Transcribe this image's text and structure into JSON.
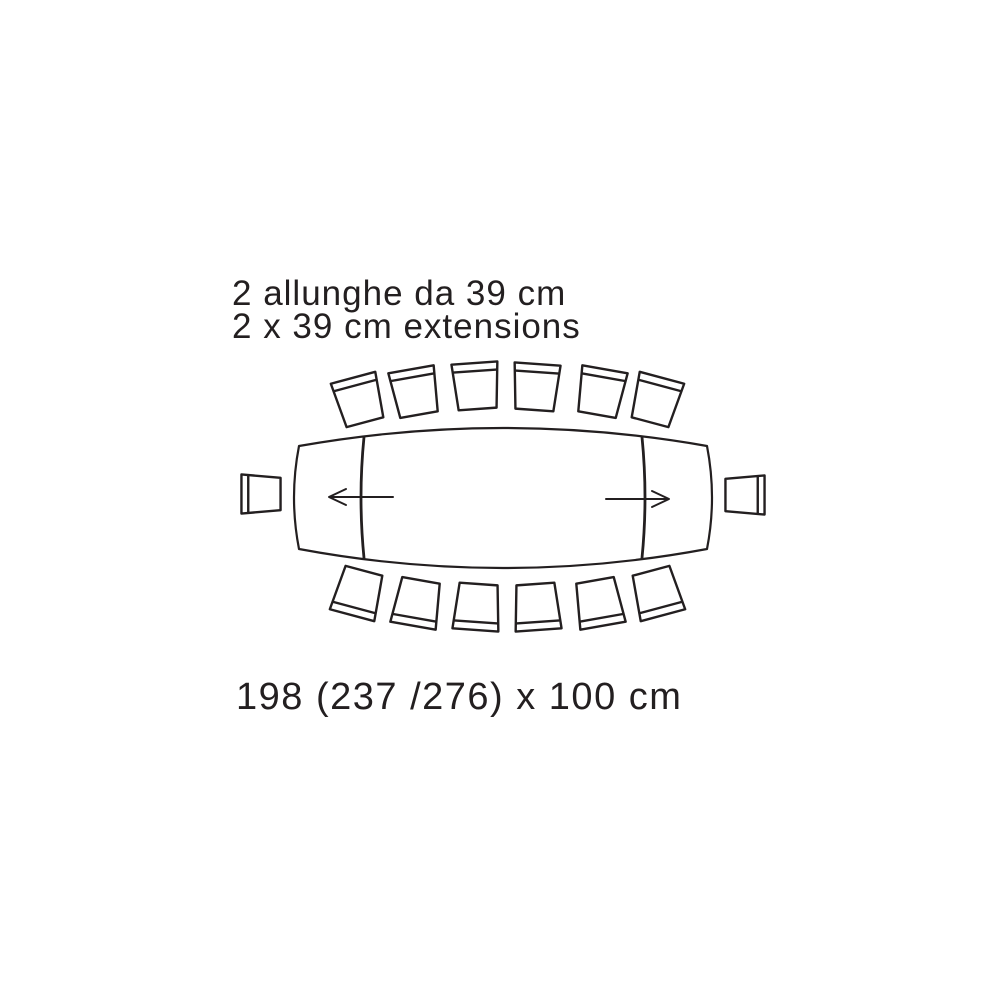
{
  "caption": {
    "line1_italian": "2 allunghe da 39 cm",
    "line2_english": "2 x 39 cm extensions"
  },
  "dimensions_label": "198 (237 /276) x 100 cm",
  "diagram": {
    "type": "extendable-dining-table-top-view",
    "table": {
      "length_closed_cm": 198,
      "length_one_extension_cm": 237,
      "length_two_extensions_cm": 276,
      "width_cm": 100,
      "extension_count": 2,
      "extension_size_cm": 39
    },
    "chairs": {
      "top_row": 6,
      "bottom_row": 6,
      "left_end": 1,
      "right_end": 1,
      "total": 14
    },
    "arrows": [
      "extension-direction-left",
      "extension-direction-right"
    ],
    "colors": {
      "line": "#231f20",
      "background": "#ffffff"
    }
  }
}
